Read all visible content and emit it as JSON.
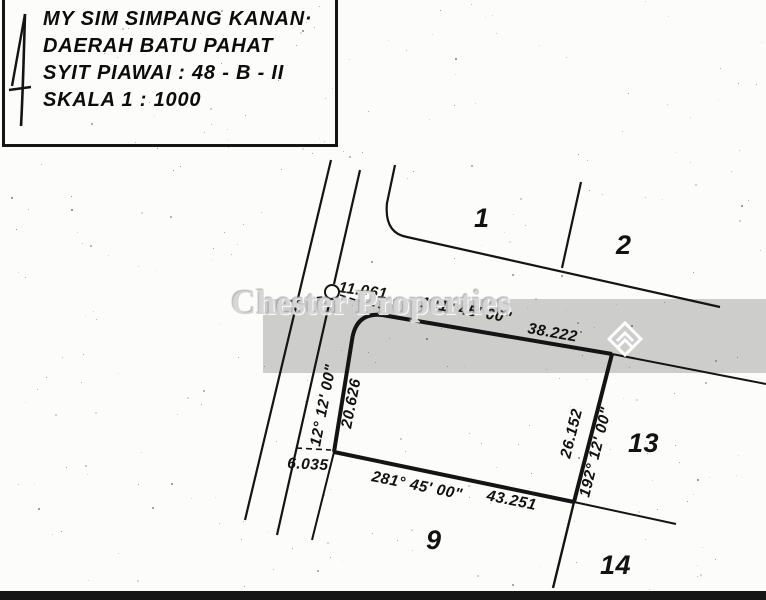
{
  "title_block": {
    "line1": "MY SIM SIMPANG KANAN·",
    "line2": "DAERAH BATU PAHAT",
    "line3": "SYIT PIAWAI : 48 - B - II",
    "line4": "SKALA 1 : 1000"
  },
  "watermark": {
    "text": "Chester Properties",
    "band_color": "#c9c9c9",
    "logo": "chester-diamond-chevron-logo",
    "logo_color": "#ffffff"
  },
  "plots": [
    "1",
    "2",
    "9",
    "13",
    "14"
  ],
  "survey": {
    "north_line": {
      "bearing": "101° 45' 00\"",
      "distance": "38.222"
    },
    "west_line": {
      "bearing": "12° 12' 00\"",
      "distance": "20.626"
    },
    "east_line": {
      "bearing": "192° 12' 00\"",
      "distance": "26.152"
    },
    "south_line": {
      "bearing": "281° 45' 00\"",
      "distance": "43.251"
    },
    "offsets": {
      "north": "11.061",
      "road": "6.035"
    }
  },
  "ink_color": "#141414"
}
